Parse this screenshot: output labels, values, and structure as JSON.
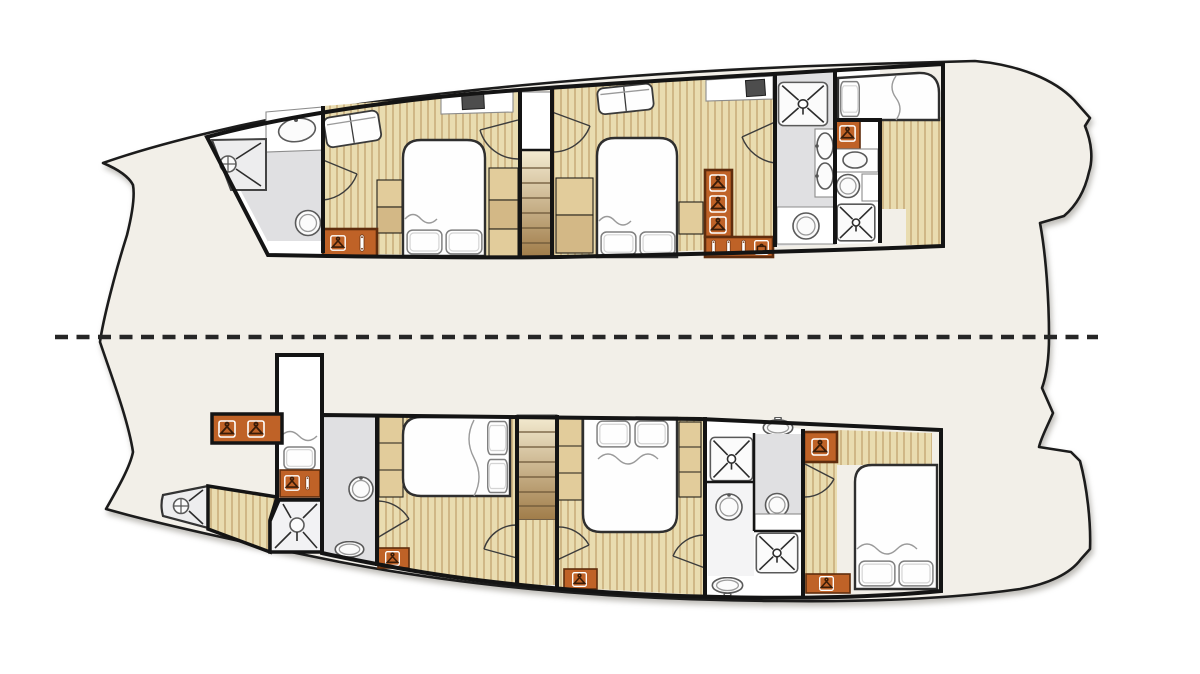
{
  "diagram": {
    "type": "catamaran-yacht-deck-plan",
    "view": "hull accommodation layout, top view, bow at left",
    "centerline": {
      "style": "dashed",
      "orientation": "horizontal"
    },
    "hulls": [
      {
        "name": "upper-hull",
        "rooms": [
          {
            "name": "forward-bathroom",
            "features": [
              "corner-shower",
              "washbasin",
              "toilet"
            ]
          },
          {
            "name": "forward-cabin",
            "features": [
              "double-bed",
              "sofa",
              "desk-with-tv",
              "wardrobe",
              "side-shelves"
            ]
          },
          {
            "name": "companionway-stairs",
            "features": [
              "steps",
              "closet"
            ]
          },
          {
            "name": "mid-cabin",
            "features": [
              "double-bed",
              "sofa",
              "desk-with-tv",
              "hanging-lockers",
              "drawers"
            ]
          },
          {
            "name": "aft-bathroom",
            "features": [
              "shower",
              "double-washbasin",
              "washbasin",
              "hanging-locker"
            ]
          },
          {
            "name": "aft-wc",
            "features": [
              "shower",
              "washbasin",
              "toilet",
              "hanging-locker"
            ]
          },
          {
            "name": "aft-cabin",
            "features": [
              "double-bed"
            ]
          }
        ]
      },
      {
        "name": "lower-hull",
        "rooms": [
          {
            "name": "bow-shower",
            "features": [
              "corner-shower"
            ]
          },
          {
            "name": "bow-corridor",
            "features": [
              "hanging-lockers"
            ]
          },
          {
            "name": "crew-berth",
            "features": [
              "single-berth",
              "locker"
            ]
          },
          {
            "name": "forward-bathroom",
            "features": [
              "washbasin",
              "toilet",
              "shower-room"
            ]
          },
          {
            "name": "forward-cabin",
            "features": [
              "double-bed",
              "side-shelves",
              "hanging-locker"
            ]
          },
          {
            "name": "companionway-stairs",
            "features": [
              "steps",
              "landing"
            ]
          },
          {
            "name": "mid-cabin",
            "features": [
              "double-bed",
              "side-shelves",
              "hanging-locker"
            ]
          },
          {
            "name": "aft-bathroom",
            "features": [
              "two-showers",
              "two-toilets",
              "two-washbasins"
            ]
          },
          {
            "name": "aft-cabin",
            "features": [
              "double-bed",
              "hanging-lockers"
            ]
          }
        ]
      }
    ],
    "fixtures_summary": {
      "beds": 7,
      "showers": 7,
      "toilets": 5,
      "washbasins": 8,
      "stair-flights": 2
    }
  },
  "colors": {
    "bg": "#ffffff",
    "hull": "#f2efe8",
    "hullStroke": "#1c1c1c",
    "wall": "#141414",
    "wood": "#e9dcb0",
    "woodStripe": "#c9ae7c",
    "shelf": "#e2cc9b",
    "shelfDark": "#d3b886",
    "cabinet": "#bf6227",
    "cabinetBorder": "#5f2d0e",
    "tile": "#e0e0e2",
    "fixture": "#fbfbfb",
    "fixtureStroke": "#5a5a5a",
    "bed": "#fefefe",
    "bedStroke": "#2f2f2f",
    "stairTop": "#f4ecd2",
    "stairBottom": "#a07c49",
    "tread": "#6b5637",
    "centerline": "#262626",
    "tv": "#4d4d4d",
    "door": "#3c3c3c",
    "wave": "#9a9a9a",
    "xmark": "#2c2c2c",
    "white": "#ffffff"
  }
}
